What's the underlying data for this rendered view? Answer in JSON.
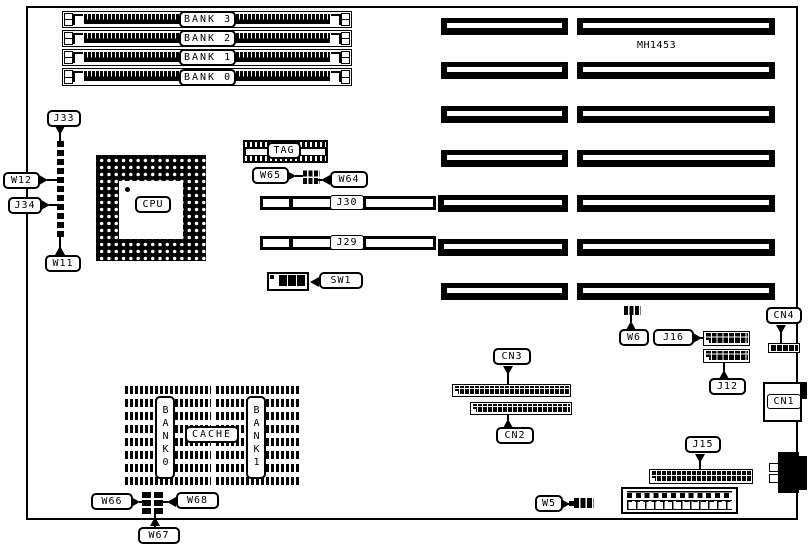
{
  "diagram": {
    "board_id": "MH1453",
    "memory_banks": [
      "BANK 3",
      "BANK 2",
      "BANK 1",
      "BANK 0"
    ],
    "labels": {
      "j33": "J33",
      "w12": "W12",
      "j34": "J34",
      "w11": "W11",
      "cpu": "CPU",
      "tag": "TAG",
      "w65": "W65",
      "w64": "W64",
      "j30": "J30",
      "j29": "J29",
      "sw1": "SW1",
      "cache_bank0": "BANK0",
      "cache": "CACHE",
      "cache_bank1": "BANK1",
      "w66": "W66",
      "w67": "W67",
      "w68": "W68",
      "cn3": "CN3",
      "cn2": "CN2",
      "w6": "W6",
      "j16": "J16",
      "j12": "J12",
      "cn4": "CN4",
      "cn1": "CN1",
      "j15": "J15",
      "w5": "W5"
    },
    "colors": {
      "ink": "#000000",
      "paper": "#ffffff"
    }
  }
}
